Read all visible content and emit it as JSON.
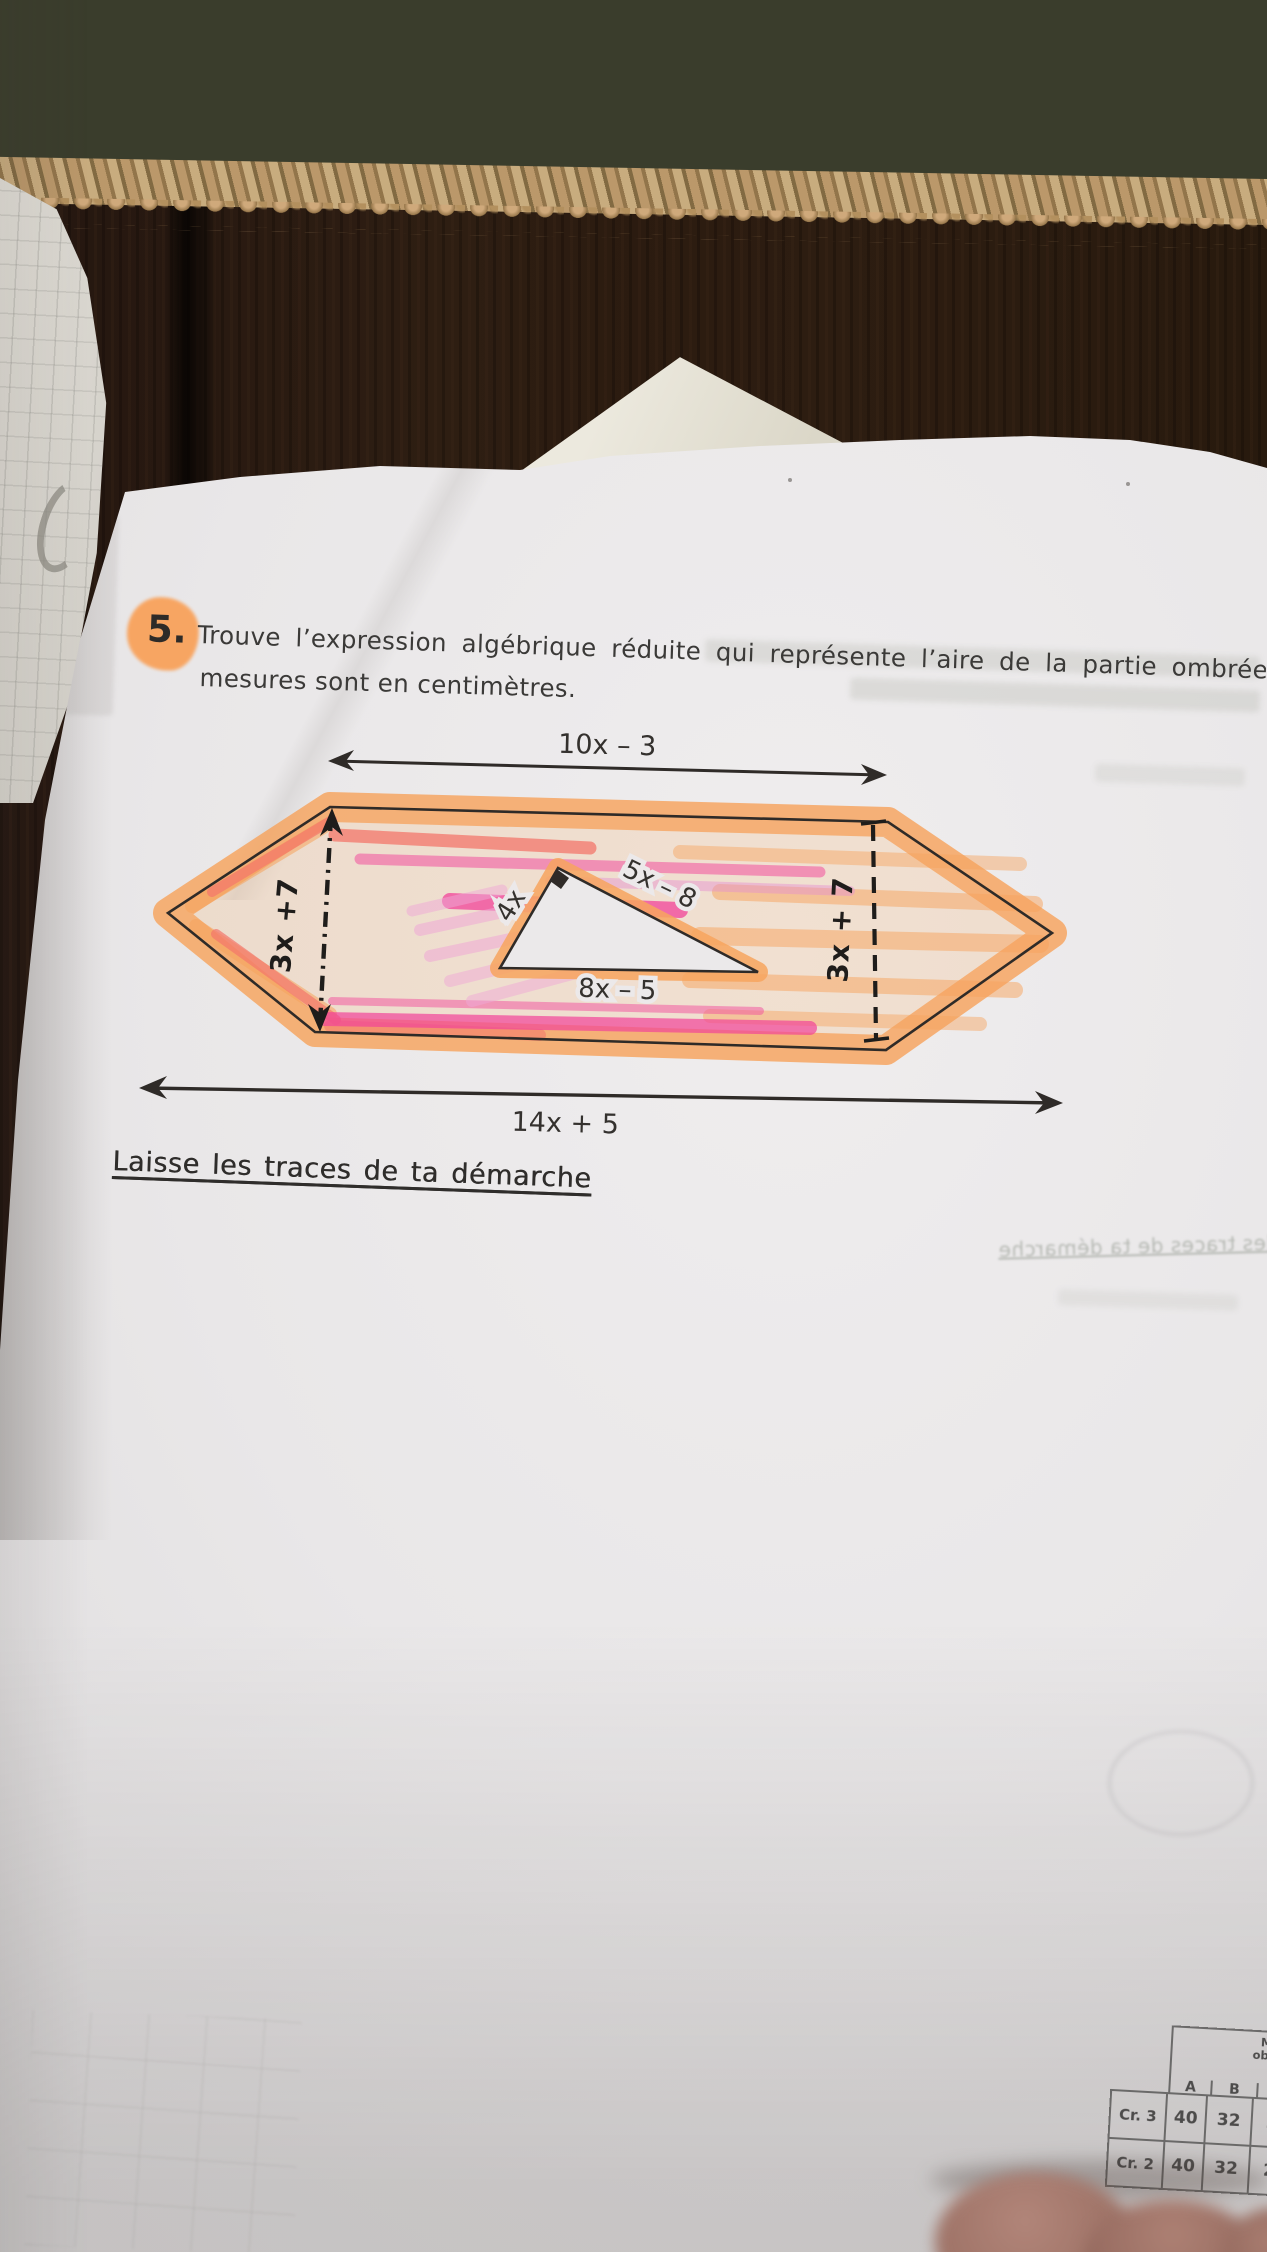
{
  "worksheet": {
    "problem": {
      "number": "5.",
      "text_line1": "Trouve l’expression algébrique réduite qui représente l’aire de la partie ombrée. L",
      "text_line2": "mesures sont en centimètres."
    },
    "figure": {
      "top_width": "10x – 3",
      "bottom_width": "14x + 5",
      "left_height": "3x +7",
      "right_height": "3x + 7",
      "triangle_side": "4x",
      "triangle_hypotenuse": "5x – 8",
      "triangle_base": "8x – 5"
    },
    "instruction": "Laisse les traces de ta démarche",
    "bleedthrough_instruction": "les traces de ta démarche"
  },
  "rubric_table": {
    "header_lines": [
      "Manife",
      "observa",
      "niv"
    ],
    "columns": [
      "A",
      "B",
      "C"
    ],
    "rows": [
      {
        "label": "Cr. 3",
        "values": [
          "40",
          "32",
          "24"
        ]
      },
      {
        "label": "Cr. 2",
        "values": [
          "40",
          "32",
          "24"
        ]
      }
    ]
  },
  "colors": {
    "highlight_orange": "#f7a45e",
    "highlight_pink": "#f2509e",
    "highlight_light_pink": "#efa9d6",
    "highlight_salmon": "#f4776b",
    "pen_black": "#2f2b28",
    "paper": "#eae8e9",
    "wood_brown": "#2b1b10",
    "rug_olive": "#3a3d2c",
    "rug_cream": "#e7e2d0",
    "rug_jute": "#bb9a67"
  }
}
